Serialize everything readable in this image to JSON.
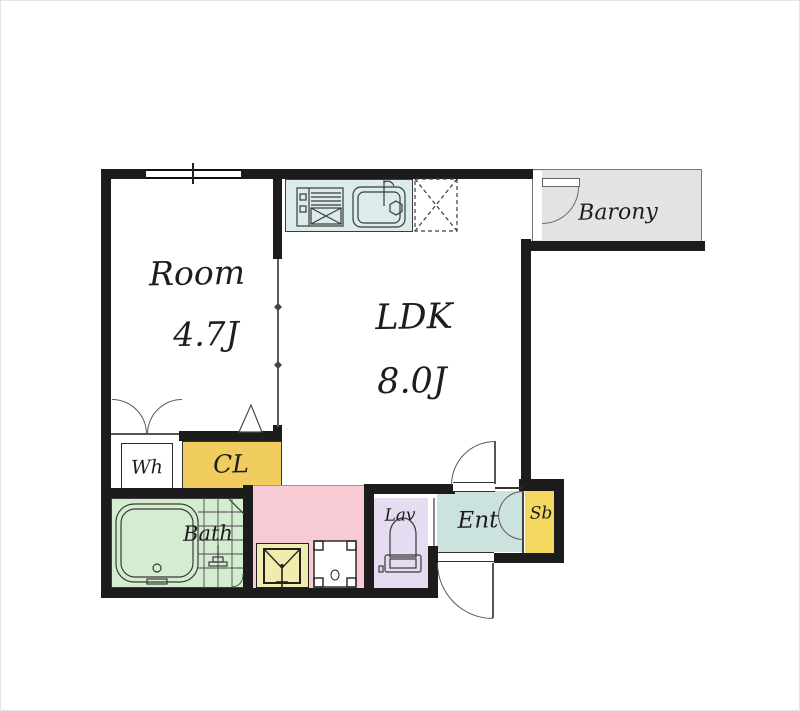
{
  "plan": {
    "title": "1LDK apartment floor plan"
  },
  "rooms": {
    "bedroom": {
      "label": "Room",
      "size": "4.7J"
    },
    "ldk": {
      "label": "LDK",
      "size": "8.0J"
    },
    "balcony": {
      "label": "Barony"
    },
    "water_heater": {
      "label": "Wh"
    },
    "closet": {
      "label": "CL"
    },
    "bath": {
      "label": "Bath"
    },
    "lavatory": {
      "label": "Lav"
    },
    "entrance": {
      "label": "Ent"
    },
    "shoe_box": {
      "label": "Sb"
    }
  },
  "colors": {
    "wall": "#1c1c1c",
    "kitchen_counter": "#dcecec",
    "closet": "#f1cd5f",
    "shoe_box": "#f4d75f",
    "bath": "#d4edd0",
    "washroom": "#f8cbd4",
    "lavatory": "#e6dcf2",
    "entrance": "#cce2de",
    "balcony": "#e3e3e3",
    "washer_pan": "#f1ecae"
  },
  "fixtures": {
    "stove": "gas-stove",
    "sink": "kitchen-sink",
    "refrigerator": "refrigerator-space",
    "bathtub": "bathtub",
    "shower": "shower-fixture",
    "toilet": "toilet",
    "washer_pan": "washing-machine-pan",
    "washer_space": "washing-machine-space"
  }
}
